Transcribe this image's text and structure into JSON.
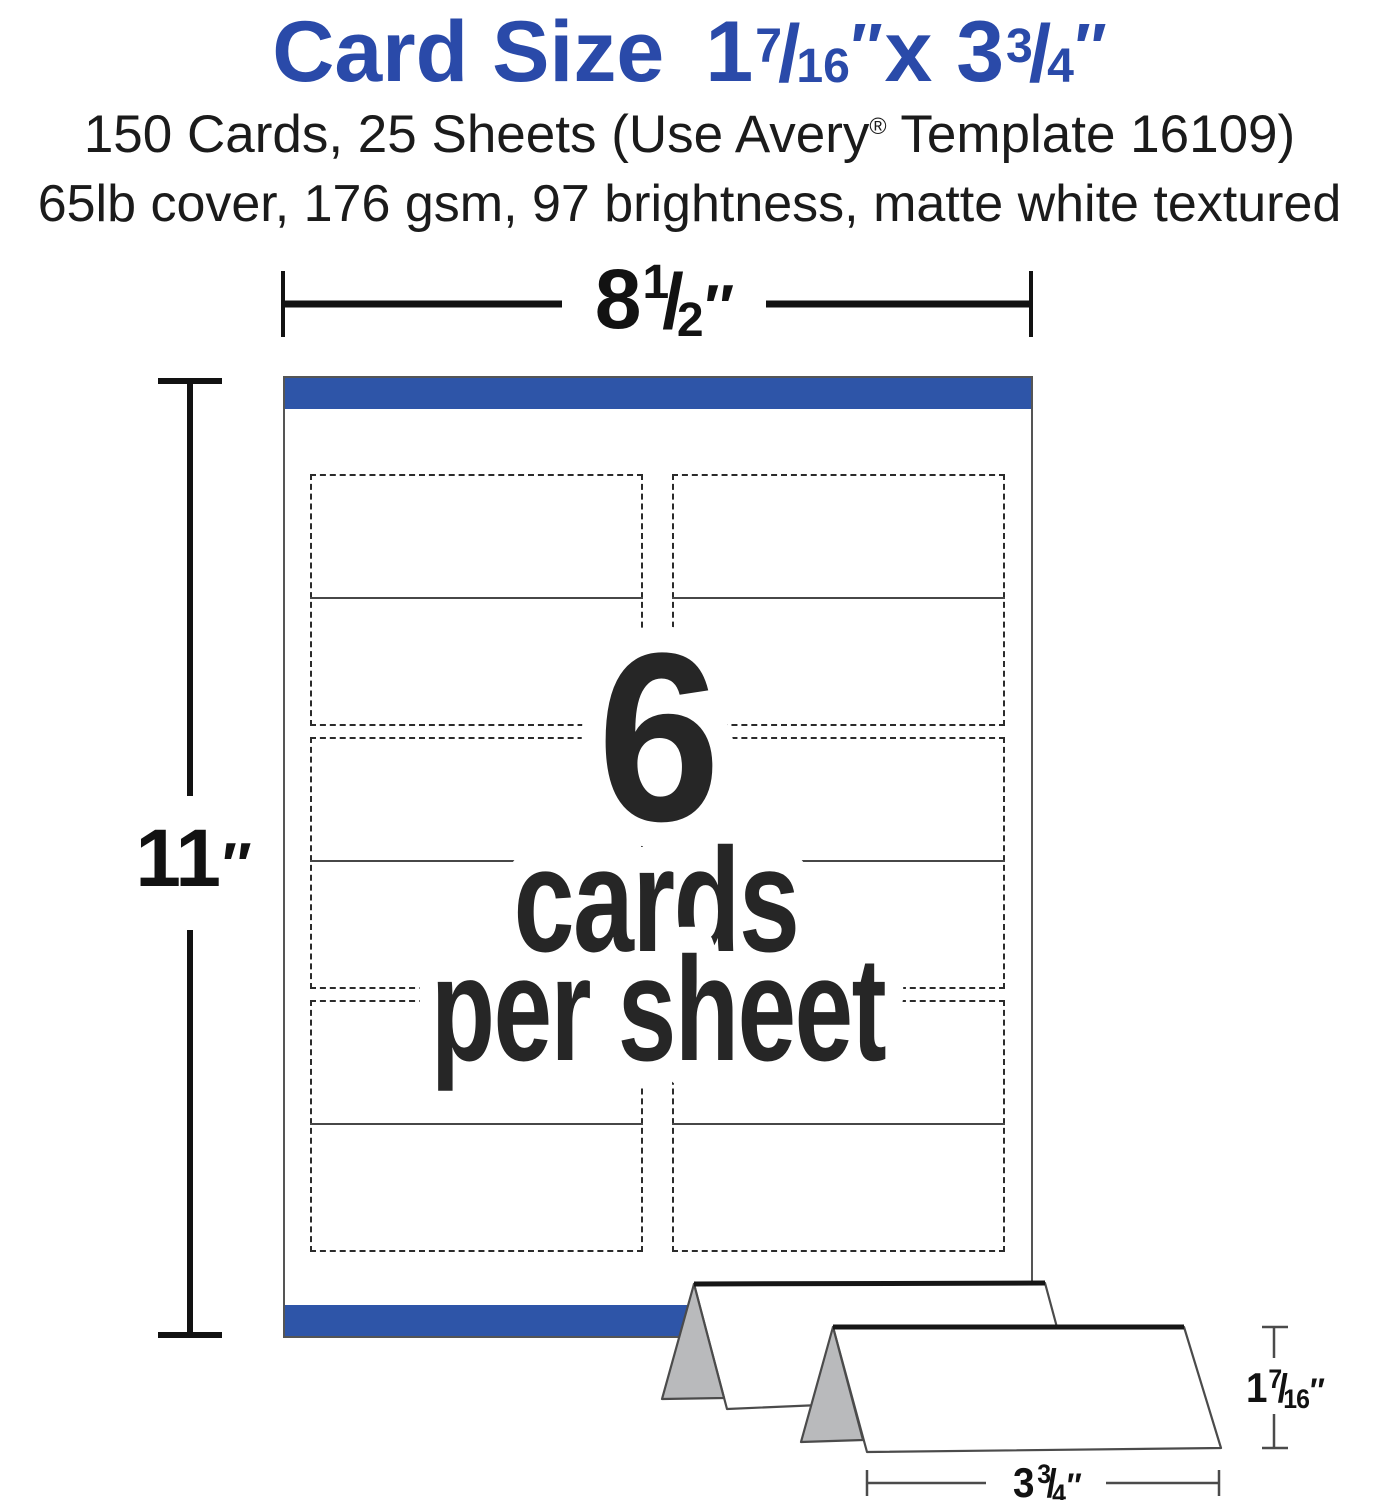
{
  "shared": {
    "slash": "/"
  },
  "colors": {
    "title_blue": "#2a4aa9",
    "bar_blue": "#2e55a8",
    "ink": "#1c1c1c",
    "big_text": "#262626",
    "dim_black": "#121212",
    "thin_line": "#4b4b4b",
    "panel_gray": "#b9babc",
    "dash": "#2b2b2b",
    "fold_line": "#474747",
    "sheet_edge": "#555555"
  },
  "header": {
    "title": {
      "prefix": "Card Size",
      "whole1": "1",
      "num1": "7",
      "den1": "16",
      "unit1": "″",
      "mid": "x 3",
      "num2": "3",
      "den2": "4",
      "unit2": "″"
    },
    "subtitle1_before_reg": "150 Cards, 25 Sheets (Use Avery",
    "subtitle1_reg": "®",
    "subtitle1_after_reg": " Template 16109)",
    "subtitle2": "65lb cover, 176 gsm, 97 brightness, matte white textured"
  },
  "diagram": {
    "sheet_width_dim": {
      "whole": "8",
      "num": "1",
      "den": "2",
      "unit": "″"
    },
    "sheet_height_dim": {
      "value": "11",
      "unit": "″"
    },
    "cards_per_sheet": {
      "count": "6",
      "word1": "cards",
      "word2": "per sheet"
    },
    "card_height_dim": {
      "whole": "1",
      "num": "7",
      "den": "16",
      "unit": "″"
    },
    "card_width_dim": {
      "whole": "3",
      "num": "3",
      "den": "4",
      "unit": "″"
    },
    "grid": {
      "columns": 2,
      "rows": 3,
      "cards_total": 6
    }
  }
}
